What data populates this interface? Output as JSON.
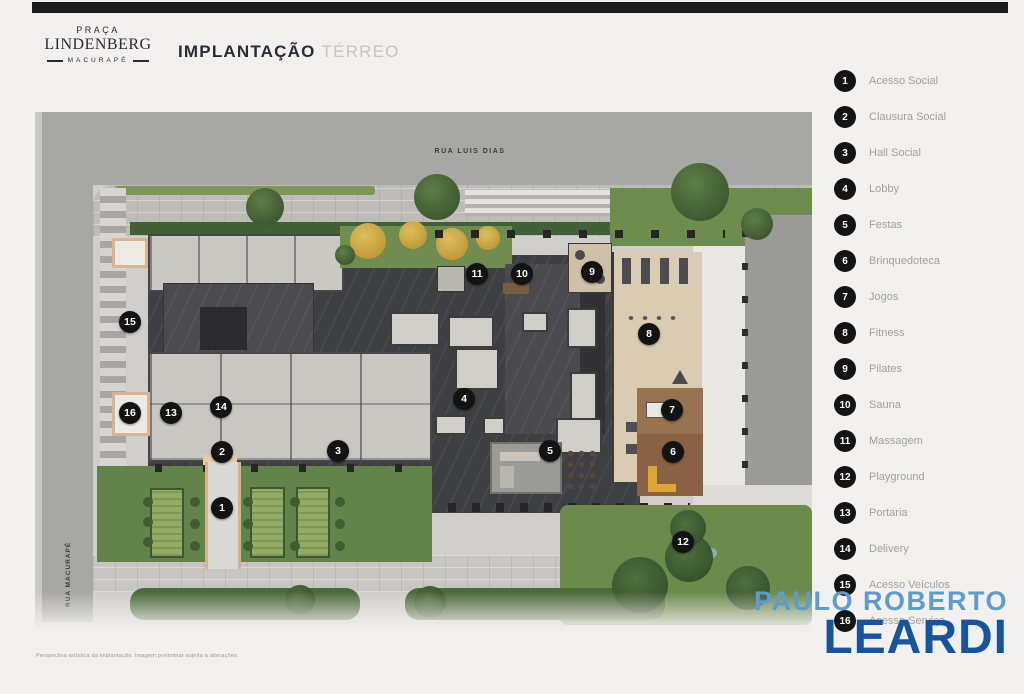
{
  "header": {
    "logo_line1": "PRAÇA",
    "logo_line2": "LINDENBERG",
    "logo_line3": "MACURAPÉ",
    "title_bold": "IMPLANTAÇÃO",
    "title_light": "TÉRREO"
  },
  "plan": {
    "street_top": "RUA LUIS DIAS",
    "street_left": "RUA MACURAPÉ",
    "markers": [
      {
        "n": "1",
        "x": 222,
        "y": 508
      },
      {
        "n": "2",
        "x": 222,
        "y": 452
      },
      {
        "n": "3",
        "x": 338,
        "y": 451
      },
      {
        "n": "4",
        "x": 464,
        "y": 399
      },
      {
        "n": "5",
        "x": 550,
        "y": 451
      },
      {
        "n": "6",
        "x": 673,
        "y": 452
      },
      {
        "n": "7",
        "x": 672,
        "y": 410
      },
      {
        "n": "8",
        "x": 649,
        "y": 334
      },
      {
        "n": "9",
        "x": 592,
        "y": 272
      },
      {
        "n": "10",
        "x": 522,
        "y": 274
      },
      {
        "n": "11",
        "x": 477,
        "y": 274
      },
      {
        "n": "12",
        "x": 683,
        "y": 542
      },
      {
        "n": "13",
        "x": 171,
        "y": 413
      },
      {
        "n": "14",
        "x": 221,
        "y": 407
      },
      {
        "n": "15",
        "x": 130,
        "y": 322
      },
      {
        "n": "16",
        "x": 130,
        "y": 413
      }
    ]
  },
  "legend": {
    "items": [
      {
        "num": "1",
        "label": "Acesso Social"
      },
      {
        "num": "2",
        "label": "Clausura Social"
      },
      {
        "num": "3",
        "label": "Hall Social"
      },
      {
        "num": "4",
        "label": "Lobby"
      },
      {
        "num": "5",
        "label": "Festas"
      },
      {
        "num": "6",
        "label": "Brinquedoteca"
      },
      {
        "num": "7",
        "label": "Jogos"
      },
      {
        "num": "8",
        "label": "Fitness"
      },
      {
        "num": "9",
        "label": "Pilates"
      },
      {
        "num": "10",
        "label": "Sauna"
      },
      {
        "num": "11",
        "label": "Massagem"
      },
      {
        "num": "12",
        "label": "Playground"
      },
      {
        "num": "13",
        "label": "Portaria"
      },
      {
        "num": "14",
        "label": "Delivery"
      },
      {
        "num": "15",
        "label": "Acesso Veículos"
      },
      {
        "num": "16",
        "label": "Acesso Serviço"
      }
    ],
    "badge_color": "#141414",
    "label_color": "#a0a0a0"
  },
  "watermark": {
    "line1": "PAULO ROBERTO",
    "line2": "LEARDI",
    "color_light": "#5d9bd3",
    "color_dark": "#17549f"
  },
  "footer": {
    "disclaimer": "Perspectiva artística da implantação. Imagem preliminar sujeita a alterações."
  }
}
